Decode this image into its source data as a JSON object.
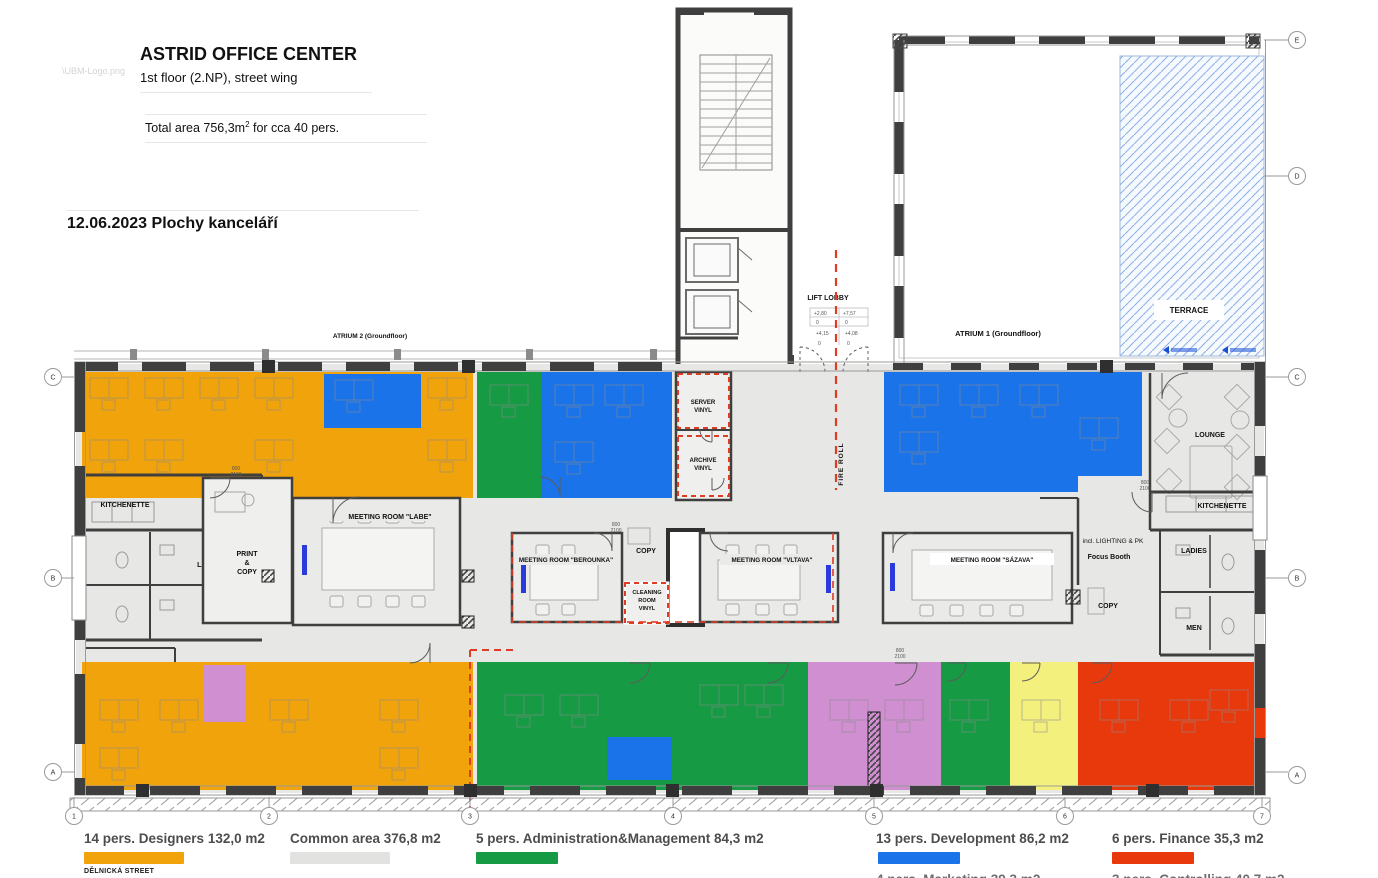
{
  "header": {
    "logo_placeholder": "\\UBM-Logo.png",
    "title": "ASTRID OFFICE CENTER",
    "subtitle": "1st floor (2.NP), street wing",
    "total_prefix": "Total area 756,3m",
    "total_sup": "2",
    "total_suffix": " for cca 40 pers.",
    "date_line": "12.06.2023 Plochy kanceláří"
  },
  "legend": {
    "row1": [
      {
        "label": "14 pers. Designers 132,0 m2",
        "color": "#F0A30A"
      },
      {
        "label": "Common area 376,8 m2",
        "color": "#E2E2E0"
      },
      {
        "label": "5 pers. Administration&Management 84,3 m2",
        "color": "#169A44"
      },
      {
        "label": "13 pers. Development 86,2 m2",
        "color": "#1A73E8"
      },
      {
        "label": "6 pers. Finance 35,3 m2",
        "color": "#E8390C"
      }
    ],
    "street": "DĚLNICKÁ STREET",
    "row2": [
      {
        "label": "4 pers. Marketing 39,3 m2",
        "color": "#CF8FD0"
      },
      {
        "label": "3 pers. Controlling 40,7 m2",
        "color": "#F3F07E"
      }
    ]
  },
  "plan": {
    "colors": {
      "designers": "#F0A30A",
      "common": "#E7E7E5",
      "admin": "#169A44",
      "development": "#1A73E8",
      "finance": "#E8390C",
      "marketing": "#CF8FD0",
      "controlling": "#F3F07E",
      "wall": "#3F3F3F",
      "fire": "#E03B24"
    },
    "labels": {
      "atrium2": "ATRIUM 2 (Groundfloor)",
      "atrium1": "ATRIUM 1 (Groundfloor)",
      "terrace": "TERRACE",
      "lounge": "LOUNGE",
      "lift_lobby": "LIFT LOBBY",
      "fire_roll": "FIRE ROLL",
      "server_1": "SERVER",
      "server_2": "VINYL",
      "archive_1": "ARCHIVE",
      "archive_2": "VINYL",
      "copy_center": "COPY",
      "cleaning_1": "CLEANING",
      "cleaning_2": "ROOM",
      "cleaning_3": "VINYL",
      "labe": "MEETING ROOM \"LABE\"",
      "berounka": "MEETING ROOM \"BEROUNKA\"",
      "vltava": "MEETING ROOM \"VLTAVA\"",
      "sazava": "MEETING ROOM \"SÁZAVA\"",
      "print_1": "PRINT",
      "print_2": "&",
      "print_3": "COPY",
      "kitchenette_left": "KITCHENETTE",
      "ladies_left": "LADIES",
      "men_left": "MEN",
      "kitchenette_right": "KITCHENETTE",
      "ladies_right": "LADIES",
      "men_right": "MEN",
      "copy_right": "COPY",
      "lighting": "incl. LIGHTING & PK",
      "focus": "Focus Booth"
    },
    "lift_table": {
      "r1c1": "+2,80",
      "r1c2": "+7,57",
      "r2c1": "0",
      "r2c2": "0",
      "r3c1": "+4,15",
      "r3c2": "+4,08",
      "r4c1": "0",
      "r4c2": "0"
    },
    "dim_mark": {
      "top": "800",
      "bottom": "2100"
    },
    "grid": {
      "bottom": [
        "1",
        "2",
        "3",
        "4",
        "5",
        "6",
        "7"
      ],
      "right": [
        "E",
        "D",
        "C",
        "B",
        "A"
      ],
      "left": [
        "C",
        "B",
        "A"
      ]
    }
  }
}
